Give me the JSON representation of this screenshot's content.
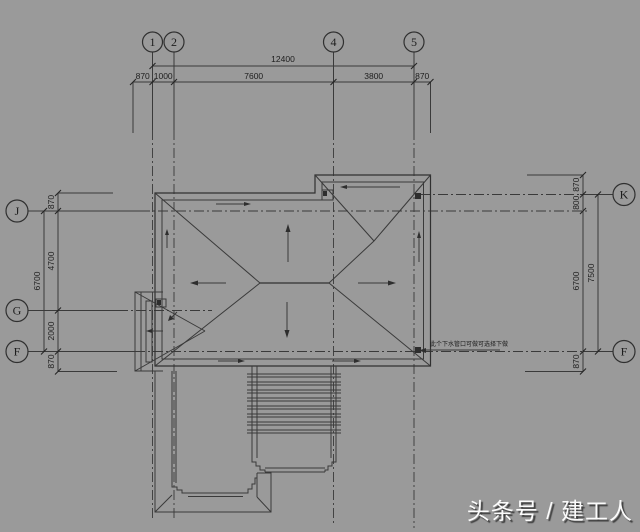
{
  "colors": {
    "background": "#9a9a9a",
    "ink": "#3a3a3a",
    "watermark_text": "#fbfbfb"
  },
  "watermark": {
    "text": "头条号 / 建工人"
  },
  "plan": {
    "grid": {
      "top": [
        {
          "id": "1"
        },
        {
          "id": "2"
        },
        {
          "id": "4"
        },
        {
          "id": "5"
        }
      ],
      "left": [
        {
          "id": "J"
        },
        {
          "id": "G"
        },
        {
          "id": "F"
        }
      ],
      "right": [
        {
          "id": "K"
        },
        {
          "id": "F"
        }
      ]
    },
    "dims": {
      "top_overall": "12400",
      "top_segments": [
        "870",
        "1000",
        "7600",
        "3800",
        "870"
      ],
      "left_overall": "6700",
      "left_segments": [
        "870",
        "4700",
        "2000",
        "870"
      ],
      "right_overall": "7500",
      "right_segments": [
        "870",
        "800",
        "6700",
        "870"
      ]
    },
    "annotation": "此个下水管口可做可选择下做"
  }
}
